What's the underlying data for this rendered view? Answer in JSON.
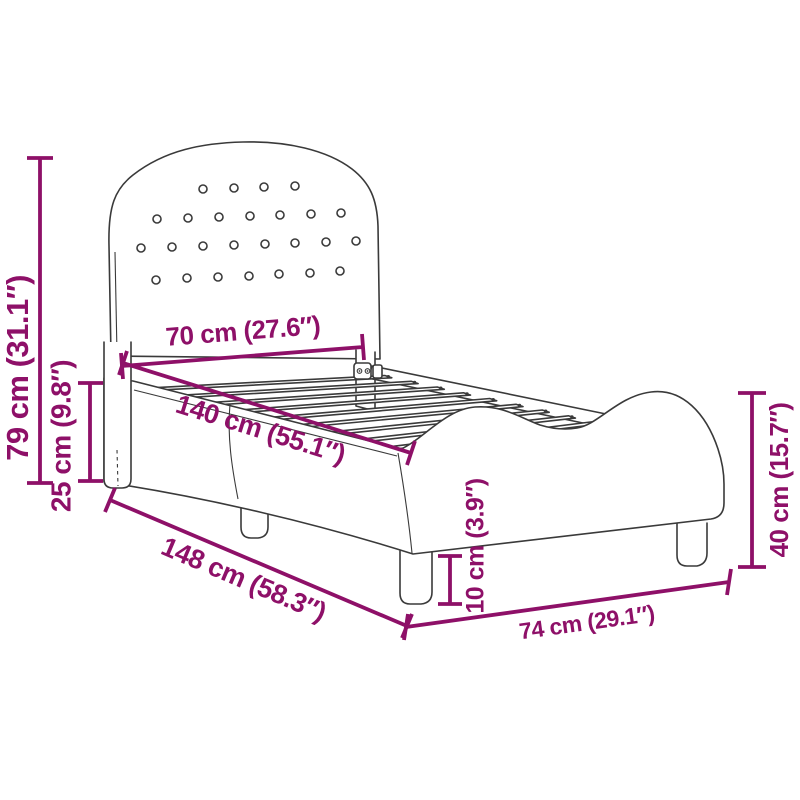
{
  "diagram": {
    "subject": "upholstered kids bed frame with tufted headboard and wavy side rails",
    "view": "perspective line drawing with dimension callouts",
    "headboard_button_count": 26,
    "visible_slat_count": 9,
    "visible_leg_count": 4
  },
  "colors": {
    "dimension": "#8E1068",
    "outline": "#3A3A3A",
    "background": "#FFFFFF"
  },
  "labels": {
    "total_height": "79 cm (31.1″)",
    "rail_height": "25 cm (9.8″)",
    "headboard_width": "70 cm (27.6″)",
    "inner_length": "140 cm (55.1″)",
    "total_length": "148 cm (58.3″)",
    "leg_height": "10 cm (3.9″)",
    "total_width": "74 cm (29.1″)",
    "footboard_height": "40 cm (15.7″)"
  }
}
